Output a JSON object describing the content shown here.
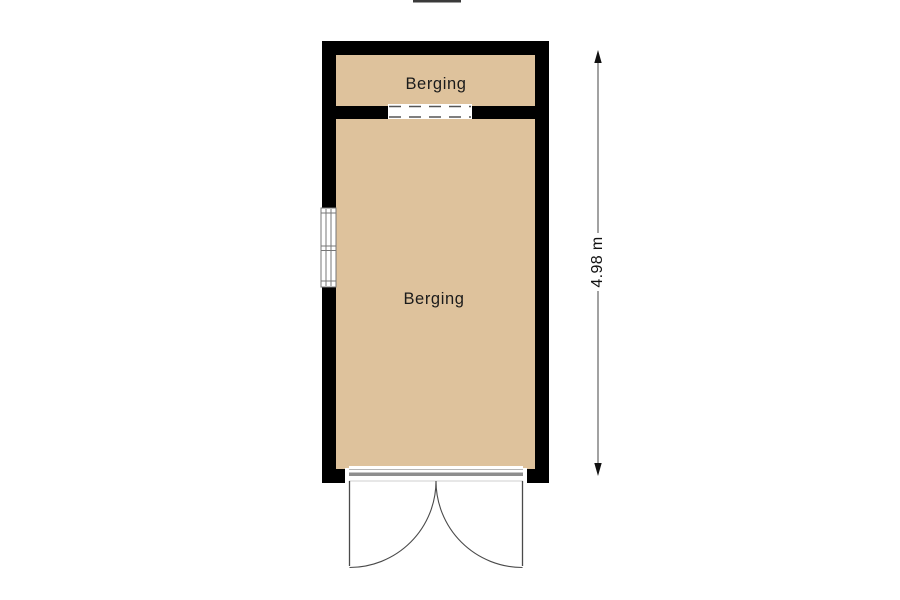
{
  "colors": {
    "wall": "#000000",
    "room_fill": "#dec29c",
    "symbol_line": "#4a4a4a",
    "window_line": "#777777",
    "threshold_gray": "#8e8e8e",
    "text": "#1b1b1b"
  },
  "floor_plan": {
    "rooms": [
      {
        "label": "Berging"
      },
      {
        "label": "Berging"
      }
    ],
    "dimension": {
      "height_label": "4.98 m"
    }
  }
}
